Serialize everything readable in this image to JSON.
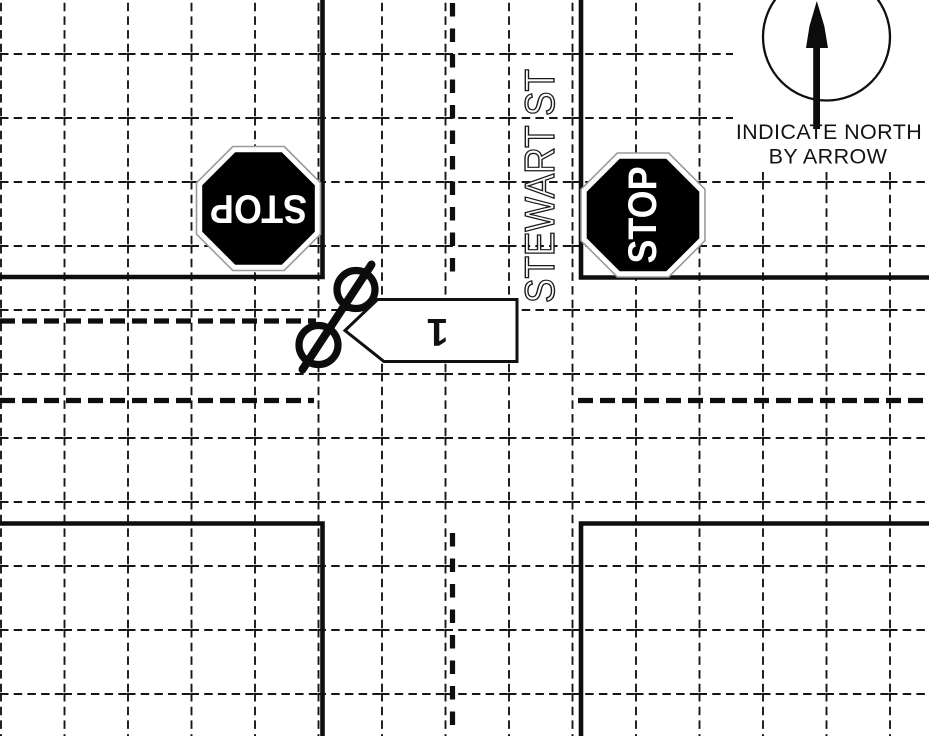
{
  "street": {
    "name_label": "STEWART ST"
  },
  "north_indicator": {
    "instruction_line1": "INDICATE NORTH",
    "instruction_line2": "BY ARROW",
    "icon": "north-arrow-icon"
  },
  "signs": {
    "west_stop_label": "STOP",
    "east_stop_label": "STOP",
    "icon": "stop-sign-icon"
  },
  "vehicles": {
    "unit1_label": "1",
    "unit1_icon": "vehicle-direction-arrow-icon",
    "bicycle_icon": "bicycle-wheels-icon"
  },
  "colors": {
    "background": "#ffffff",
    "line_ink": "#101010",
    "sign_fill": "#000000",
    "sign_text": "#ffffff",
    "sign_rim": "#ffffff",
    "sign_rim_edge": "#9a9a9a",
    "symbol_fill": "#ffffff"
  }
}
